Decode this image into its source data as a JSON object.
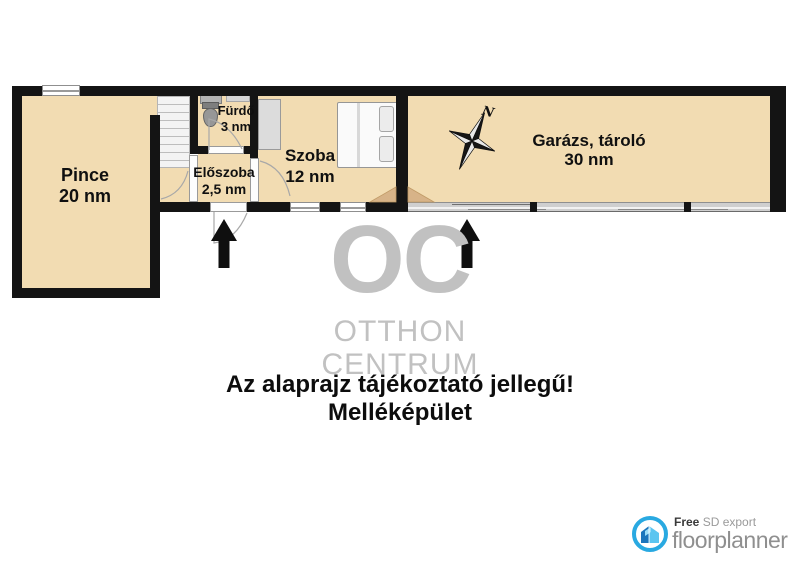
{
  "floor_plan": {
    "north_label": "N",
    "rooms": [
      {
        "name": "Pince",
        "area": "20 nm"
      },
      {
        "name": "Fürdő",
        "area": "3 nm"
      },
      {
        "name": "Előszoba",
        "area": "2,5 nm"
      },
      {
        "name": "Szoba",
        "area": "12 nm"
      },
      {
        "name": "Garázs, tároló",
        "area": "30 nm"
      }
    ]
  },
  "watermark": {
    "logo": "OC",
    "line1": "OTTHON",
    "line2": "CENTRUM"
  },
  "caption": {
    "line1": "Az alaprajz tájékoztató jellegű!",
    "line2": "Melléképület"
  },
  "footer": {
    "free_label": "Free",
    "export_label": "SD export",
    "brand": "floorplanner"
  },
  "colors": {
    "floor_tan": "#F2DCB2",
    "wall_black": "#141414",
    "watermark_gray": "#C1C1C1",
    "brand_blue": "#29A9E1",
    "brand_dark_blue": "#1B75BC",
    "brand_light_blue": "#5BC5F0",
    "brand_text_gray": "#8F8F8F",
    "door_swing_tan": "#D7B388"
  }
}
